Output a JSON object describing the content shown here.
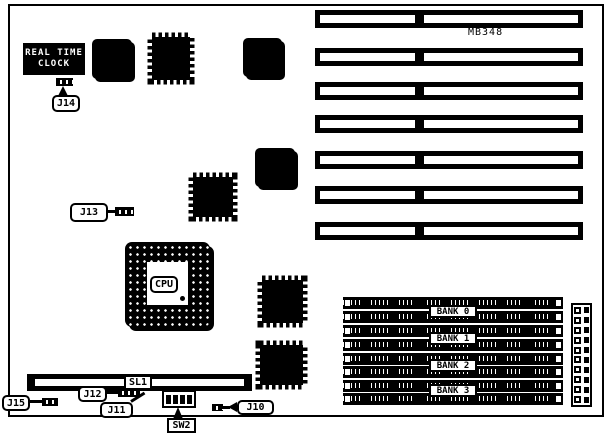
{
  "diagram": {
    "type": "motherboard-layout-figure",
    "model_label": "MB348",
    "colors": {
      "ink": "#000000",
      "bg": "#ffffff"
    }
  },
  "labels": {
    "rtc_line1": "REAL TIME",
    "rtc_line2": "CLOCK",
    "model": "MB348",
    "cpu": "CPU",
    "sl1": "SL1",
    "sw2": "SW2"
  },
  "jumpers": {
    "j10": "J10",
    "j11": "J11",
    "j12": "J12",
    "j13": "J13",
    "j14": "J14",
    "j15": "J15"
  },
  "banks": [
    {
      "label": "BANK 0"
    },
    {
      "label": "BANK 1"
    },
    {
      "label": "BANK 2"
    },
    {
      "label": "BANK 3"
    }
  ],
  "components": {
    "expansion_slot_count": 7,
    "simm_socket_count": 8,
    "dip_switch_positions": 4
  }
}
